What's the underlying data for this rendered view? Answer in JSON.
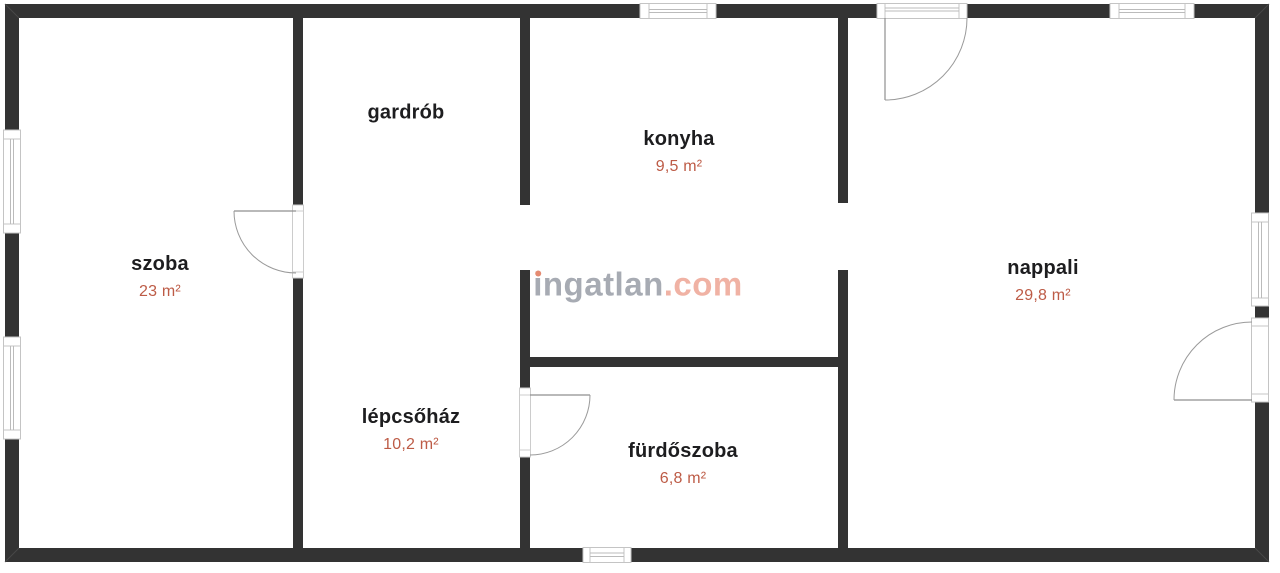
{
  "watermark": {
    "brand": "ingatlan",
    "suffix": ".com"
  },
  "rooms": [
    {
      "name": "szoba",
      "area": "23 m²"
    },
    {
      "name": "gardrób",
      "area": ""
    },
    {
      "name": "konyha",
      "area": "9,5 m²"
    },
    {
      "name": "nappali",
      "area": "29,8 m²"
    },
    {
      "name": "lépcsőház",
      "area": "10,2 m²"
    },
    {
      "name": "fürdőszoba",
      "area": "6,8 m²"
    }
  ],
  "colors": {
    "wall": "#333333",
    "room_text": "#1d1d1f",
    "area_text": "#bd5b46",
    "watermark_gray": "#a7abb3",
    "watermark_accent": "#f0b2a4",
    "watermark_dot": "#e58b72",
    "frame_stroke": "#c4c4c4",
    "door_arc": "#9a9a9a"
  }
}
